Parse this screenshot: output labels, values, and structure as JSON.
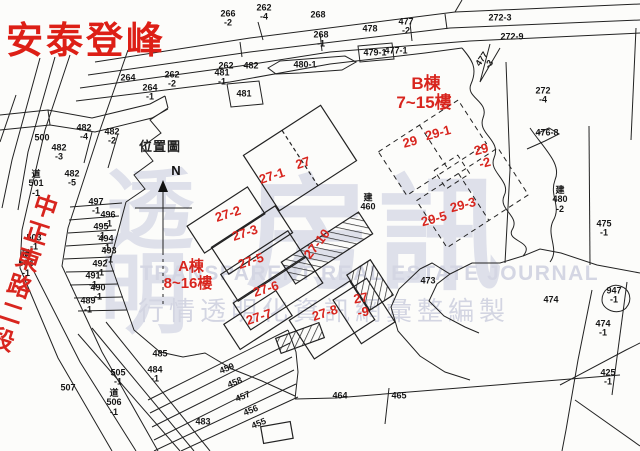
{
  "title": "安泰登峰",
  "map": {
    "road_name": "中正東路二段",
    "inset_title": "位置圖",
    "north": "N",
    "block_a_name": "A棟",
    "block_a_floors": "8~16樓",
    "block_b_name": "B棟",
    "block_b_floors": "7~15樓"
  },
  "units": [
    {
      "label": "27"
    },
    {
      "label": "27-1"
    },
    {
      "label": "27-2"
    },
    {
      "label": "27-3"
    },
    {
      "label": "27-5"
    },
    {
      "label": "27-6"
    },
    {
      "label": "27-7"
    },
    {
      "label": "27-8"
    },
    {
      "label": "27\n-9"
    },
    {
      "label": "27-10"
    },
    {
      "label": "29"
    },
    {
      "label": "29-1"
    },
    {
      "label": "29\n-2"
    },
    {
      "label": "29-5"
    },
    {
      "label": "29-3"
    }
  ],
  "parcels": [
    {
      "label": "264"
    },
    {
      "label": "262\n-2"
    },
    {
      "label": "264\n-1"
    },
    {
      "label": "266\n-2"
    },
    {
      "label": "262\n-4"
    },
    {
      "label": "268"
    },
    {
      "label": "268\n-1"
    },
    {
      "label": "478"
    },
    {
      "label": "477\n-2"
    },
    {
      "label": "477-1"
    },
    {
      "label": "479-1"
    },
    {
      "label": "480-1"
    },
    {
      "label": "262"
    },
    {
      "label": "482"
    },
    {
      "label": "481\n-1"
    },
    {
      "label": "481"
    },
    {
      "label": "272-3"
    },
    {
      "label": "272-9"
    },
    {
      "label": "477\n-3"
    },
    {
      "label": "272\n-4"
    },
    {
      "label": "476-8"
    },
    {
      "label": "建\n480\n-2"
    },
    {
      "label": "475\n-1"
    },
    {
      "label": "947\n-1"
    },
    {
      "label": "474\n-1"
    },
    {
      "label": "425\n-1"
    },
    {
      "label": "473"
    },
    {
      "label": "474"
    },
    {
      "label": "建\n460"
    },
    {
      "label": "500"
    },
    {
      "label": "482\n-4"
    },
    {
      "label": "482\n-2"
    },
    {
      "label": "482\n-3"
    },
    {
      "label": "482\n-5"
    },
    {
      "label": "道\n501\n-1"
    },
    {
      "label": "497\n-1"
    },
    {
      "label": "496\n-1"
    },
    {
      "label": "495\n-1"
    },
    {
      "label": "494\n-1"
    },
    {
      "label": "493\n-1"
    },
    {
      "label": "492\n-1"
    },
    {
      "label": "491\n-1"
    },
    {
      "label": "490\n-1"
    },
    {
      "label": "489\n-1"
    },
    {
      "label": "503\n-1"
    },
    {
      "label": "道\n504\n-1"
    },
    {
      "label": "505\n-1"
    },
    {
      "label": "道\n506\n-1"
    },
    {
      "label": "507"
    },
    {
      "label": "485"
    },
    {
      "label": "484\n-1"
    },
    {
      "label": "483"
    },
    {
      "label": "459"
    },
    {
      "label": "458"
    },
    {
      "label": "457"
    },
    {
      "label": "456"
    },
    {
      "label": "455"
    },
    {
      "label": "464"
    },
    {
      "label": "465"
    }
  ],
  "watermark": {
    "big_left_top": "透",
    "big_left_bottom": "明",
    "big_right": "房訊",
    "english": "TRANSPARENT REAL ESTATE JOURNAL",
    "tagline": "行情透明化資訊網彙整編製"
  },
  "colors": {
    "red": "#d8251e",
    "line": "#222222",
    "watermark": "#dee0ea"
  }
}
